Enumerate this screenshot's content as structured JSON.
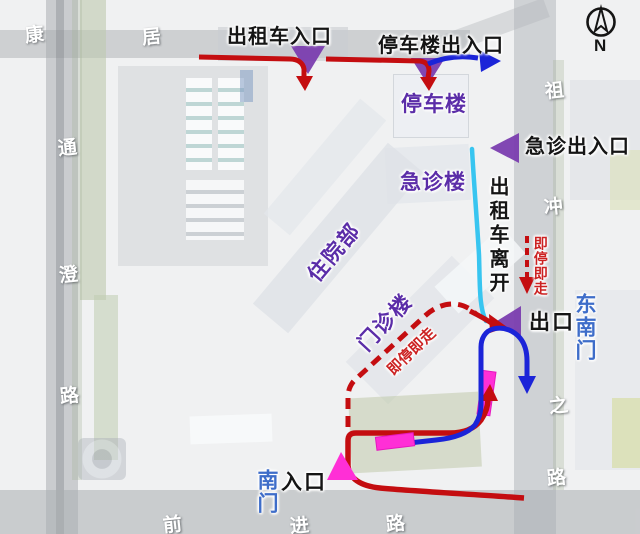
{
  "annotations": {
    "taxi_entrance": "出租车入口",
    "parking_gate": "停车楼出入口",
    "parking_building": "停车楼",
    "emergency_gate": "急诊出入口",
    "emergency_building": "急诊楼",
    "inpatient_building": "住院部",
    "outpatient_building": "门诊楼",
    "taxi_departure": "出租车离开",
    "stop_and_go_right": "即停即走",
    "stop_and_go_diagonal": "即停即走",
    "exit": "出口",
    "entrance": "入口",
    "south_gate": "南门",
    "southeast_gate": "东南门"
  },
  "roads": {
    "top": [
      "康",
      "居"
    ],
    "left": [
      "通",
      "澄",
      "路"
    ],
    "bottom": [
      "前",
      "进",
      "路"
    ],
    "right": [
      "祖",
      "冲",
      "之",
      "路"
    ]
  },
  "compass": {
    "label": "N"
  },
  "colors": {
    "route_red": "#c40d10",
    "route_blue": "#1b24d8",
    "route_cyan": "#38c5f0",
    "marker_purple": "#7a3daf",
    "label_purple": "#5b2da8",
    "gate_blue": "#3e6dc9",
    "highlight_magenta": "#ff2fd6",
    "note_red": "#cc2222"
  }
}
